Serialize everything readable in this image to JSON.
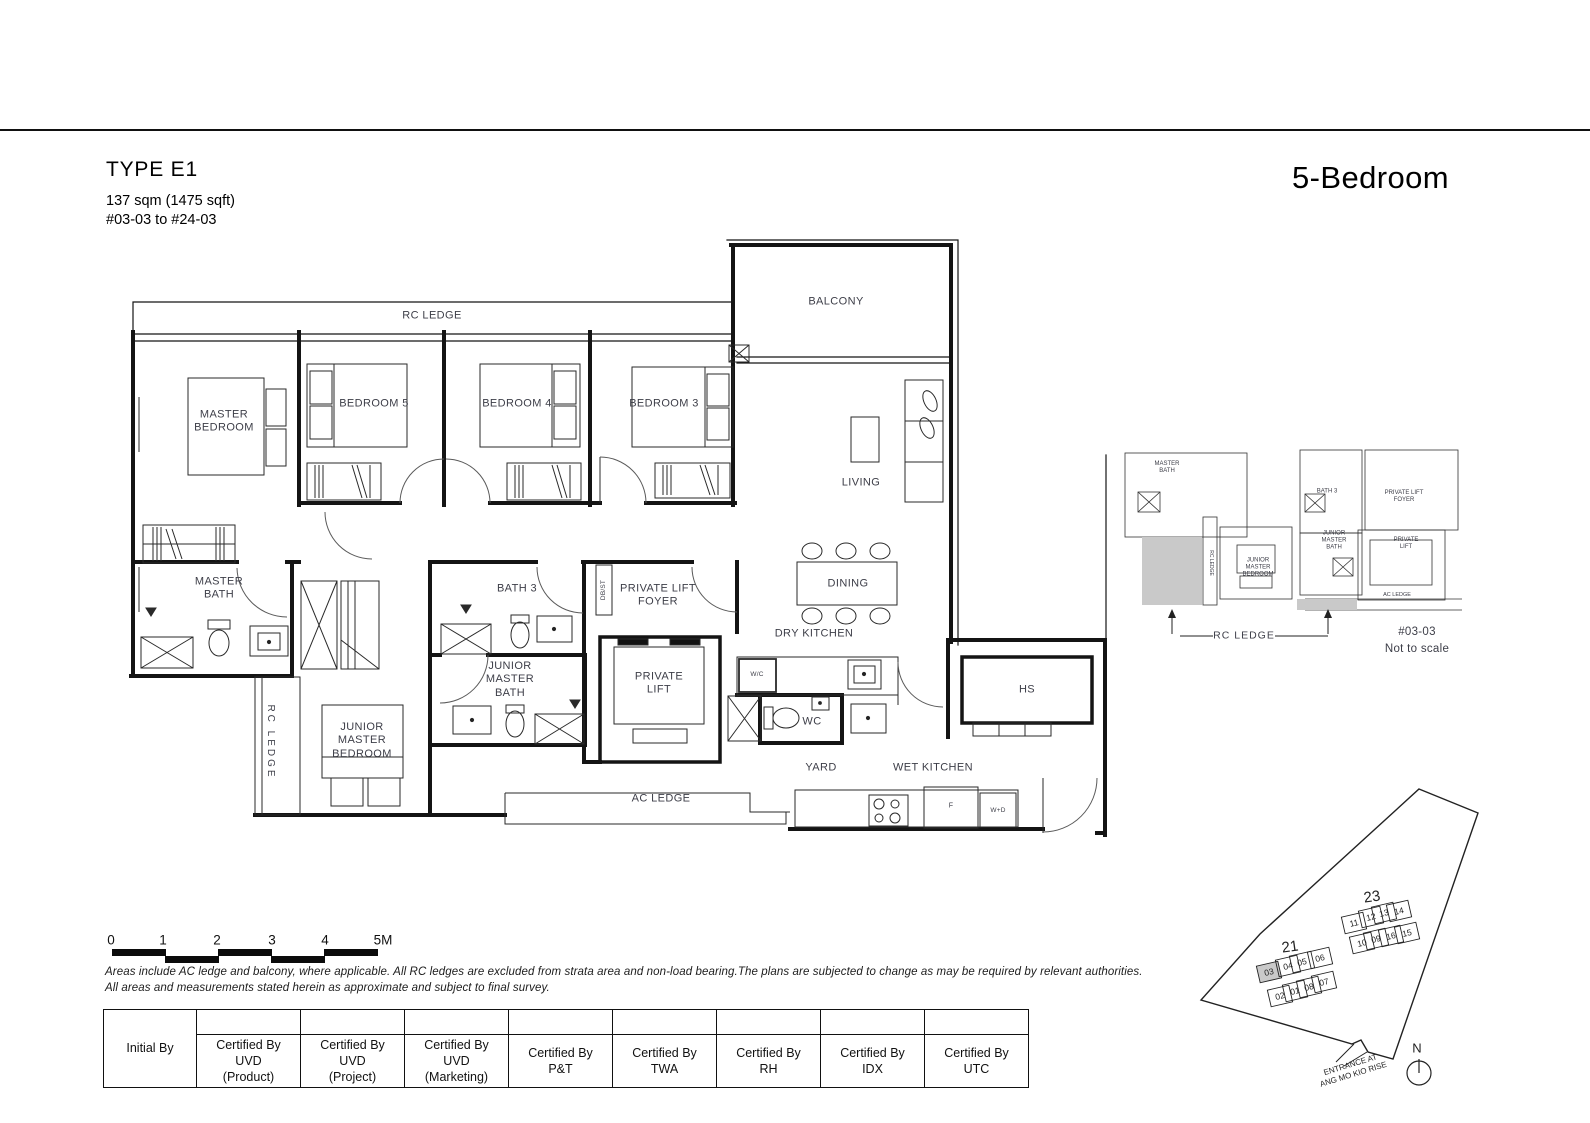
{
  "header": {
    "type_title": "TYPE E1",
    "area": "137 sqm (1475 sqft)",
    "stack_range": "#03-03 to #24-03",
    "unit_type": "5-Bedroom"
  },
  "floorplan": {
    "rooms": {
      "rc_ledge_top": "RC LEDGE",
      "balcony": "BALCONY",
      "master_bedroom": "MASTER BEDROOM",
      "bedroom5": "BEDROOM 5",
      "bedroom4": "BEDROOM 4",
      "bedroom3": "BEDROOM 3",
      "living": "LIVING",
      "dining": "DINING",
      "dry_kitchen": "DRY KITCHEN",
      "master_bath": "MASTER BATH",
      "bath3": "BATH 3",
      "private_lift_foyer": "PRIVATE LIFT FOYER",
      "db_st": "DB/ST",
      "private_lift": "PRIVATE LIFT",
      "junior_master_bath": "JUNIOR MASTER BATH",
      "junior_master_bedroom": "JUNIOR MASTER BEDROOM",
      "rc_ledge_left": "RC LEDGE",
      "wc_compartment": "W/C",
      "wc": "WC",
      "yard": "YARD",
      "wet_kitchen": "WET KITCHEN",
      "hs": "HS",
      "ac_ledge": "AC LEDGE",
      "fridge": "F",
      "washer_dryer": "W+D"
    }
  },
  "keyplan": {
    "labels": {
      "master_bath": "MASTER BATH",
      "bath3": "BATH 3",
      "private_lift_foyer": "PRIVATE LIFT FOYER",
      "junior_master_bath": "JUNIOR MASTER BATH",
      "junior_master_bedroom": "JUNIOR MASTER BEDROOM",
      "private_lift": "PRIVATE LIFT",
      "ac_ledge": "AC LEDGE",
      "rc_ledge_vertical": "RC LEDGE",
      "rc_ledge_callout": "RC LEDGE"
    },
    "unit": "#03-03",
    "scale_note": "Not to scale",
    "shade_color": "#c9c9c9"
  },
  "scalebar": {
    "ticks": [
      "0",
      "1",
      "2",
      "3",
      "4",
      "5M"
    ]
  },
  "disclaimer": {
    "line1": "Areas include AC ledge and balcony, where applicable. All RC ledges are excluded from strata area and non-load bearing.The plans are subjected to change as may be required by relevant authorities.",
    "line2": "All areas and measurements stated herein as approximate and subject to final survey."
  },
  "table": {
    "initial_by": "Initial By",
    "columns": [
      "Certified By\nUVD\n(Product)",
      "Certified By\nUVD\n(Project)",
      "Certified By\nUVD\n(Marketing)",
      "Certified By\nP&T",
      "Certified By\nTWA",
      "Certified By\nRH",
      "Certified By\nIDX",
      "Certified By\nUTC"
    ]
  },
  "siteplan": {
    "block21": {
      "label": "21",
      "top_row": [
        "03",
        "04",
        "05",
        "06"
      ],
      "bottom_row": [
        "02",
        "01",
        "08",
        "07"
      ],
      "highlighted": "03"
    },
    "block23": {
      "label": "23",
      "top_row": [
        "11",
        "12",
        "13",
        "14"
      ],
      "bottom_row": [
        "10",
        "09",
        "16",
        "15"
      ]
    },
    "north": "N",
    "entrance_line1": "ENTRANCE AT",
    "entrance_line2": "ANG MO KIO RISE",
    "highlight_color": "#c9c9c9"
  }
}
